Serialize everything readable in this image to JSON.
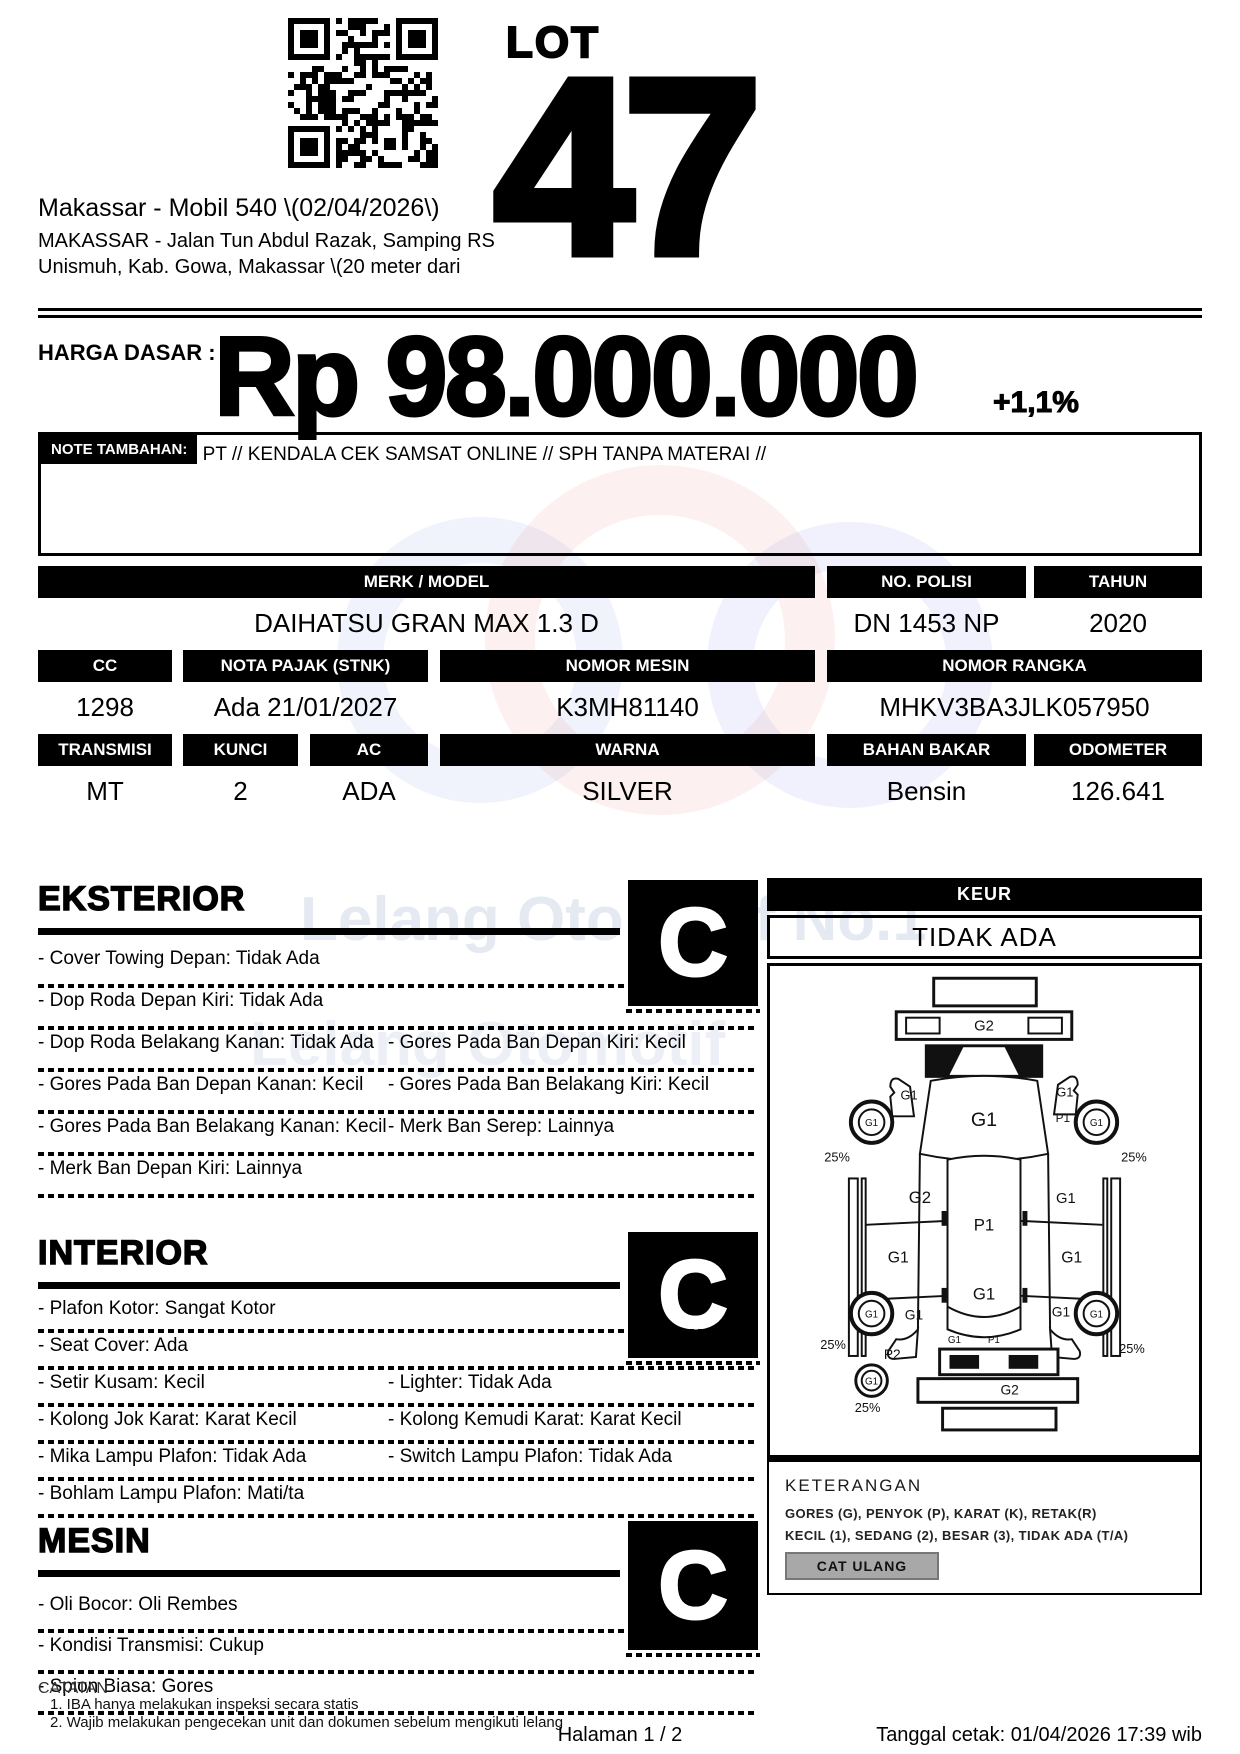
{
  "header": {
    "lot_label": "LOT",
    "lot_number": "47",
    "venue_title": "Makassar - Mobil 540 \\(02/04/2026\\)",
    "venue_line2": "MAKASSAR - Jalan Tun Abdul Razak, Samping RS",
    "venue_line3": "Unismuh, Kab. Gowa, Makassar \\(20 meter dari"
  },
  "price": {
    "label": "HARGA DASAR :",
    "amount": "Rp 98.000.000",
    "increment": "+1,1%"
  },
  "note": {
    "label": "NOTE TAMBAHAN:",
    "text": "AN PT // KENDALA CEK SAMSAT ONLINE // SPH TANPA MATERAI //"
  },
  "specs": {
    "merk_model": {
      "label": "MERK / MODEL",
      "value": "DAIHATSU GRAN MAX 1.3 D"
    },
    "no_polisi": {
      "label": "NO. POLISI",
      "value": "DN 1453 NP"
    },
    "tahun": {
      "label": "TAHUN",
      "value": "2020"
    },
    "cc": {
      "label": "CC",
      "value": "1298"
    },
    "nota_pajak": {
      "label": "NOTA PAJAK (STNK)",
      "value": "Ada 21/01/2027"
    },
    "nomor_mesin": {
      "label": "NOMOR MESIN",
      "value": "K3MH81140"
    },
    "nomor_rangka": {
      "label": "NOMOR RANGKA",
      "value": "MHKV3BA3JLK057950"
    },
    "transmisi": {
      "label": "TRANSMISI",
      "value": "MT"
    },
    "kunci": {
      "label": "KUNCI",
      "value": "2"
    },
    "ac": {
      "label": "AC",
      "value": "ADA"
    },
    "warna": {
      "label": "WARNA",
      "value": "SILVER"
    },
    "bahan_bakar": {
      "label": "BAHAN BAKAR",
      "value": "Bensin"
    },
    "odometer": {
      "label": "ODOMETER",
      "value": "126.641"
    }
  },
  "keur": {
    "label": "KEUR",
    "value": "TIDAK ADA"
  },
  "sections": {
    "eksterior": {
      "title": "EKSTERIOR",
      "grade": "C",
      "items": [
        {
          "left": "- Cover Towing Depan: Tidak Ada",
          "right": ""
        },
        {
          "left": "- Dop Roda Depan Kiri: Tidak Ada",
          "right": ""
        },
        {
          "left": "- Dop Roda Belakang Kanan: Tidak Ada",
          "right": "- Gores Pada Ban Depan Kiri: Kecil"
        },
        {
          "left": "- Gores Pada Ban Depan Kanan: Kecil",
          "right": "- Gores Pada Ban Belakang Kiri: Kecil"
        },
        {
          "left": "- Gores Pada Ban Belakang Kanan: Kecil",
          "right": "- Merk Ban Serep: Lainnya"
        },
        {
          "left": "- Merk Ban Depan Kiri: Lainnya",
          "right": ""
        }
      ]
    },
    "interior": {
      "title": "INTERIOR",
      "grade": "C",
      "items": [
        {
          "left": "- Plafon Kotor: Sangat Kotor",
          "right": ""
        },
        {
          "left": "- Seat Cover: Ada",
          "right": ""
        },
        {
          "left": "- Setir Kusam: Kecil",
          "right": "- Lighter: Tidak Ada"
        },
        {
          "left": "- Kolong Jok Karat: Karat Kecil",
          "right": "- Kolong Kemudi Karat: Karat Kecil"
        },
        {
          "left": "- Mika Lampu Plafon: Tidak Ada",
          "right": "- Switch Lampu Plafon: Tidak Ada"
        },
        {
          "left": "- Bohlam Lampu Plafon: Mati/ta",
          "right": ""
        }
      ]
    },
    "mesin": {
      "title": "MESIN",
      "grade": "C",
      "items": [
        {
          "left": "- Oli Bocor: Oli Rembes",
          "right": ""
        },
        {
          "left": "- Kondisi Transmisi: Cukup",
          "right": ""
        },
        {
          "left": "- Spion Biasa: Gores",
          "right": ""
        }
      ]
    }
  },
  "diagram": {
    "labels": [
      {
        "t": "G2",
        "x": 217,
        "y": 65,
        "fs": 15
      },
      {
        "t": "G1",
        "x": 141,
        "y": 135,
        "fs": 13
      },
      {
        "t": "G1",
        "x": 299,
        "y": 132,
        "fs": 13
      },
      {
        "t": "G1",
        "x": 103,
        "y": 162,
        "fs": 10
      },
      {
        "t": "G1",
        "x": 331,
        "y": 162,
        "fs": 10
      },
      {
        "t": "P1",
        "x": 297,
        "y": 158,
        "fs": 12
      },
      {
        "t": "25%",
        "x": 68,
        "y": 198,
        "fs": 13
      },
      {
        "t": "25%",
        "x": 369,
        "y": 198,
        "fs": 13
      },
      {
        "t": "G1",
        "x": 217,
        "y": 162,
        "fs": 20
      },
      {
        "t": "G2",
        "x": 152,
        "y": 240,
        "fs": 17
      },
      {
        "t": "G1",
        "x": 300,
        "y": 240,
        "fs": 15
      },
      {
        "t": "P1",
        "x": 217,
        "y": 268,
        "fs": 17
      },
      {
        "t": "G1",
        "x": 130,
        "y": 300,
        "fs": 16
      },
      {
        "t": "G1",
        "x": 306,
        "y": 300,
        "fs": 16
      },
      {
        "t": "G1",
        "x": 217,
        "y": 338,
        "fs": 17
      },
      {
        "t": "G1",
        "x": 146,
        "y": 358,
        "fs": 14
      },
      {
        "t": "G1",
        "x": 295,
        "y": 355,
        "fs": 14
      },
      {
        "t": "G1",
        "x": 103,
        "y": 356,
        "fs": 10
      },
      {
        "t": "G1",
        "x": 331,
        "y": 356,
        "fs": 10
      },
      {
        "t": "25%",
        "x": 64,
        "y": 388,
        "fs": 13
      },
      {
        "t": "P2",
        "x": 124,
        "y": 398,
        "fs": 14
      },
      {
        "t": "25%",
        "x": 367,
        "y": 392,
        "fs": 13
      },
      {
        "t": "G1",
        "x": 103,
        "y": 424,
        "fs": 10
      },
      {
        "t": "25%",
        "x": 99,
        "y": 452,
        "fs": 13
      },
      {
        "t": "G1",
        "x": 187,
        "y": 382,
        "fs": 10
      },
      {
        "t": "P1",
        "x": 227,
        "y": 382,
        "fs": 10
      },
      {
        "t": "G2",
        "x": 243,
        "y": 434,
        "fs": 14
      }
    ]
  },
  "keterangan": {
    "title": "KETERANGAN",
    "line1": "GORES (G), PENYOK (P), KARAT (K), RETAK(R)",
    "line2": "KECIL (1), SEDANG (2), BESAR (3), TIDAK ADA (T/A)",
    "cat_ulang": "CAT ULANG"
  },
  "catatan": {
    "title": "CATATAN",
    "line1": "1. IBA hanya melakukan inspeksi secara statis",
    "line2": "2. Wajib melakukan pengecekan unit dan dokumen sebelum mengikuti lelang"
  },
  "footer": {
    "page": "Halaman 1 / 2",
    "printed": "Tanggal cetak: 01/04/2026 17:39 wib"
  },
  "colors": {
    "ink": "#000000",
    "watermark_blue": "#aebcd8",
    "watermark_red": "#e8b8b0",
    "button_gray": "#a8a8a8"
  }
}
